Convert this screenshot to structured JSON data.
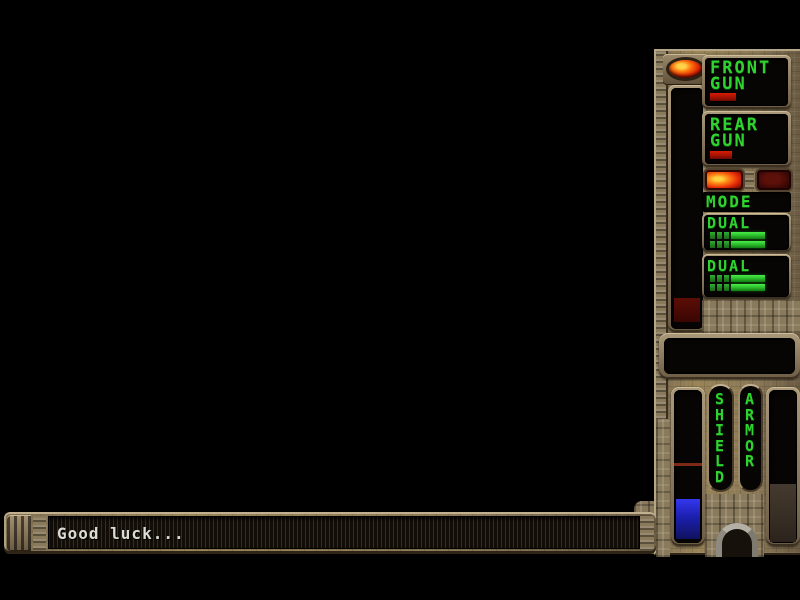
{
  "colors": {
    "hud_green": "#2fd32f",
    "bronze": "#8a7856",
    "indicator_red": "#c01404",
    "shield_blue": "#2326d0",
    "display_black": "#070504"
  },
  "sidebar": {
    "front_gun": {
      "line1": "FRONT",
      "line2": "GUN"
    },
    "rear_gun": {
      "line1": "REAR",
      "line2": "GUN"
    },
    "mode_label": "MODE",
    "dual_top_label": "DUAL",
    "dual_bottom_label": "DUAL",
    "shield_label": "SHIELD",
    "armor_label": "ARMOR"
  },
  "message_bar": {
    "text": "Good luck..."
  },
  "state": {
    "power_led": "lit",
    "front_gun_ammo_bar": "red",
    "rear_gun_ammo_bar": "red",
    "mode_button_left": "lit",
    "mode_button_right": "unlit",
    "dual_top_rows": 2,
    "dual_bottom_rows": 2,
    "shield_energy_level": "low",
    "missile_bar_block": "dark-red",
    "status_display": "empty"
  }
}
